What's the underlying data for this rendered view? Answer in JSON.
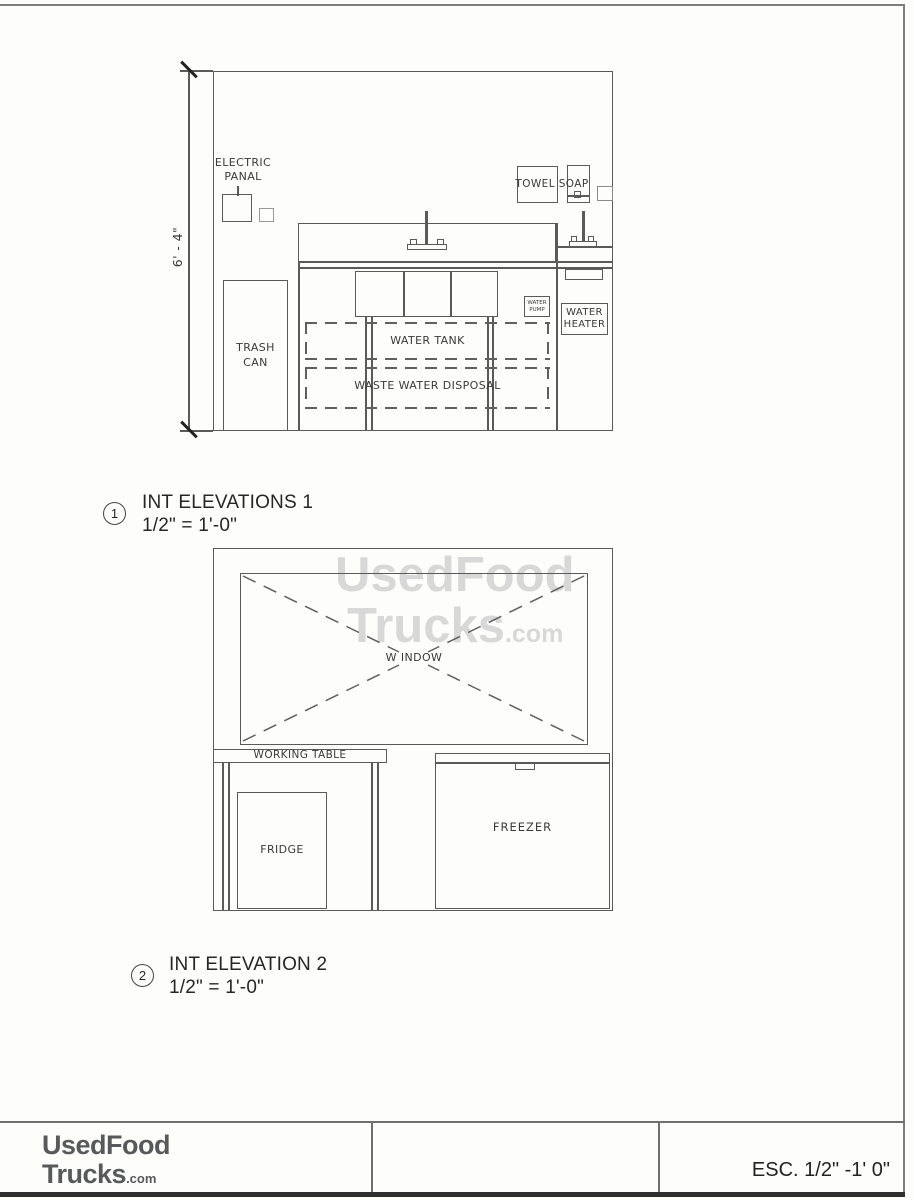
{
  "watermark": {
    "line1": "UsedFood",
    "line2": "Trucks",
    "suffix": ".com"
  },
  "elevation1": {
    "number": "1",
    "title": "INT ELEVATIONS 1",
    "scale": "1/2\" = 1'-0\"",
    "dimension": "6' - 4\"",
    "labels": {
      "electric_panel": [
        "ELECTRIC",
        "PANAL"
      ],
      "trash_can": [
        "TRASH",
        "CAN"
      ],
      "towel_soap": "TOWEL SOAP",
      "water_tank": "WATER TANK",
      "waste_water": "WASTE WATER DISPOSAL",
      "water_pump": [
        "WATER",
        "PUMP"
      ],
      "water_heater": [
        "WATER",
        "HEATER"
      ]
    }
  },
  "elevation2": {
    "number": "2",
    "title": "INT ELEVATION 2",
    "scale": "1/2\" = 1'-0\"",
    "labels": {
      "window": "W INDOW",
      "working_table": "WORKING TABLE",
      "fridge": "FRIDGE",
      "freezer": "FREEZER"
    }
  },
  "footer": {
    "logo_line1": "UsedFood",
    "logo_line2": "Trucks",
    "logo_suffix": ".com",
    "scale_note": "ESC. 1/2\" -1' 0\""
  }
}
